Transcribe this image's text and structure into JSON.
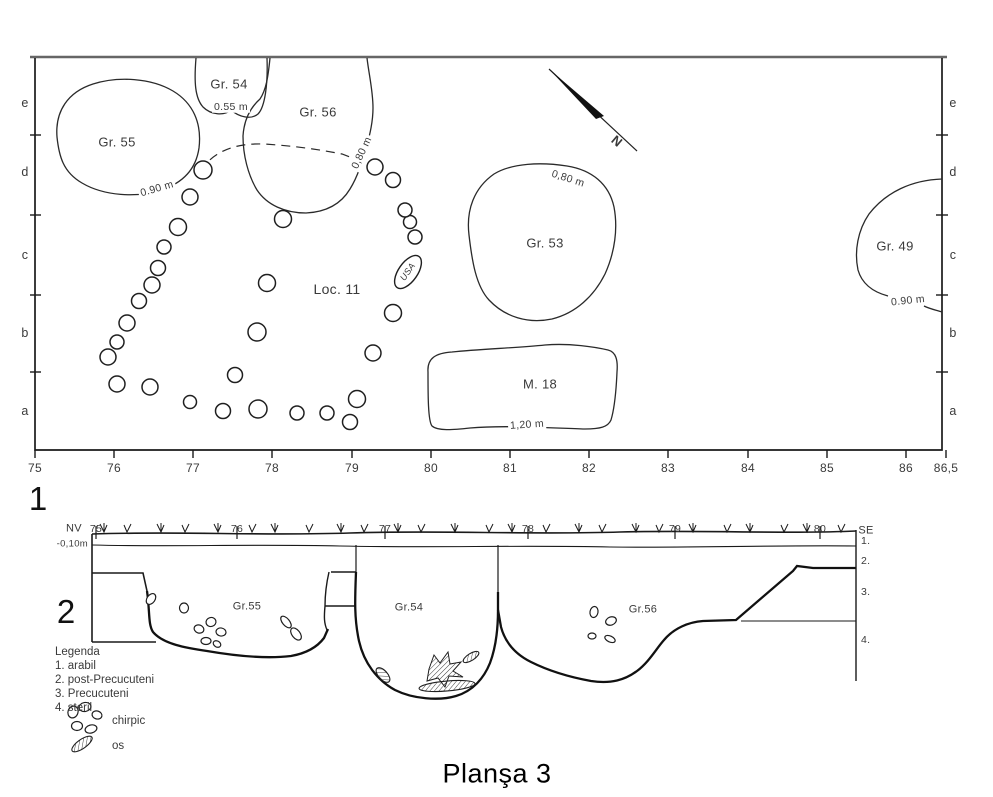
{
  "title": "Planşa 3",
  "plan": {
    "figure_number": "1",
    "axis_x": {
      "labels": [
        "75",
        "76",
        "77",
        "78",
        "79",
        "80",
        "81",
        "82",
        "83",
        "84",
        "85",
        "86",
        "86,5"
      ],
      "positions": [
        35,
        114,
        193,
        272,
        352,
        431,
        510,
        589,
        668,
        748,
        827,
        906,
        946
      ]
    },
    "rows": {
      "labels": [
        "e",
        "d",
        "c",
        "b",
        "a"
      ],
      "y": [
        103,
        172,
        255,
        333,
        411
      ],
      "left_x": 25,
      "right_x": 953,
      "tick_y": [
        135,
        215,
        295,
        372
      ]
    },
    "features": [
      {
        "label": "Gr. 55",
        "x": 117,
        "y": 142,
        "depth": "0.90 m",
        "depth_x": 157,
        "depth_y": 189,
        "depth_rot": -16
      },
      {
        "label": "Gr. 54",
        "x": 229,
        "y": 84,
        "depth": "0.55 m",
        "depth_x": 231,
        "depth_y": 107,
        "depth_rot": 0
      },
      {
        "label": "Gr. 56",
        "x": 318,
        "y": 112,
        "depth": "0,80 m",
        "depth_x": 362,
        "depth_y": 153,
        "depth_rot": -65
      },
      {
        "label": "Gr. 53",
        "x": 545,
        "y": 243,
        "depth": "0,80 m",
        "depth_x": 568,
        "depth_y": 179,
        "depth_rot": 18
      },
      {
        "label": "Gr. 49",
        "x": 895,
        "y": 246,
        "depth": "0.90 m",
        "depth_x": 908,
        "depth_y": 301,
        "depth_rot": -6
      },
      {
        "label": "M. 18",
        "x": 540,
        "y": 384,
        "depth": "1,20 m",
        "depth_x": 527,
        "depth_y": 425,
        "depth_rot": -4
      },
      {
        "label": "Loc. 11",
        "x": 337,
        "y": 289,
        "size": 14
      }
    ],
    "find_oval": {
      "text": "USA",
      "x": 408,
      "y": 272,
      "rot": -55
    },
    "north": {
      "text": "N",
      "x": 617,
      "y": 141,
      "rot": 40
    },
    "postholes": [
      [
        203,
        170,
        9
      ],
      [
        190,
        197,
        8
      ],
      [
        178,
        227,
        8.5
      ],
      [
        164,
        247,
        7
      ],
      [
        158,
        268,
        7.5
      ],
      [
        152,
        285,
        8
      ],
      [
        139,
        301,
        7.5
      ],
      [
        127,
        323,
        8
      ],
      [
        117,
        342,
        7
      ],
      [
        108,
        357,
        8
      ],
      [
        117,
        384,
        8
      ],
      [
        150,
        387,
        8
      ],
      [
        190,
        402,
        6.5
      ],
      [
        223,
        411,
        7.5
      ],
      [
        258,
        409,
        9
      ],
      [
        297,
        413,
        7
      ],
      [
        327,
        413,
        7
      ],
      [
        350,
        422,
        7.5
      ],
      [
        357,
        399,
        8.5
      ],
      [
        373,
        353,
        8
      ],
      [
        393,
        313,
        8.5
      ],
      [
        415,
        237,
        7
      ],
      [
        410,
        222,
        6.5
      ],
      [
        405,
        210,
        7
      ],
      [
        393,
        180,
        7.5
      ],
      [
        375,
        167,
        8
      ],
      [
        267,
        283,
        8.5
      ],
      [
        257,
        332,
        9
      ],
      [
        235,
        375,
        7.5
      ],
      [
        283,
        219,
        8.5
      ]
    ]
  },
  "section": {
    "figure_number": "2",
    "direction_left": "NV",
    "direction_right": "SE",
    "elevation_label": "-0,10m",
    "meter_marks": {
      "labels": [
        "75",
        "76",
        "77",
        "78",
        "79",
        "80"
      ],
      "positions": [
        96,
        237,
        385,
        528,
        675,
        820
      ]
    },
    "layer_marks": [
      {
        "label": "1.",
        "y": 541
      },
      {
        "label": "2.",
        "y": 561
      },
      {
        "label": "3.",
        "y": 592
      },
      {
        "label": "4.",
        "y": 640
      }
    ],
    "features": [
      {
        "label": "Gr.55",
        "x": 247,
        "y": 607
      },
      {
        "label": "Gr.54",
        "x": 409,
        "y": 608
      },
      {
        "label": "Gr.56",
        "x": 643,
        "y": 610
      }
    ]
  },
  "legend": {
    "title": "Legenda",
    "items": [
      "1. arabil",
      "2. post-Precucuteni",
      "3. Precucuteni",
      "4. steril"
    ],
    "symbols": [
      {
        "label": "chirpic"
      },
      {
        "label": "os"
      }
    ]
  },
  "symbols_geometry": {
    "chirpic_marks": [
      [
        151,
        599,
        4,
        6,
        35
      ],
      [
        184,
        608,
        4.5,
        5,
        0
      ],
      [
        199,
        629,
        5,
        4,
        20
      ],
      [
        211,
        622,
        5,
        4.5,
        -15
      ],
      [
        221,
        632,
        5,
        4,
        10
      ],
      [
        206,
        641,
        5,
        3.5,
        0
      ],
      [
        217,
        644,
        4,
        3,
        30
      ],
      [
        286,
        622,
        7,
        3.5,
        50
      ],
      [
        296,
        634,
        7,
        4,
        52
      ],
      [
        594,
        612,
        4,
        5.5,
        10
      ],
      [
        611,
        621,
        5.5,
        4,
        -20
      ],
      [
        592,
        636,
        4,
        3,
        0
      ],
      [
        610,
        639,
        5.5,
        3,
        25
      ],
      [
        73,
        712,
        5,
        6,
        20
      ],
      [
        85,
        707,
        6,
        4.5,
        -10
      ],
      [
        97,
        715,
        5,
        4,
        15
      ],
      [
        77,
        726,
        5.5,
        4.5,
        0
      ],
      [
        91,
        729,
        6,
        4,
        -15
      ]
    ],
    "bone_marks": [
      [
        447,
        686,
        28,
        5,
        -5
      ],
      [
        383,
        675,
        9,
        4.5,
        48
      ],
      [
        471,
        657,
        9,
        3.5,
        -32
      ],
      [
        82,
        744,
        12,
        4.5,
        -35
      ]
    ]
  }
}
